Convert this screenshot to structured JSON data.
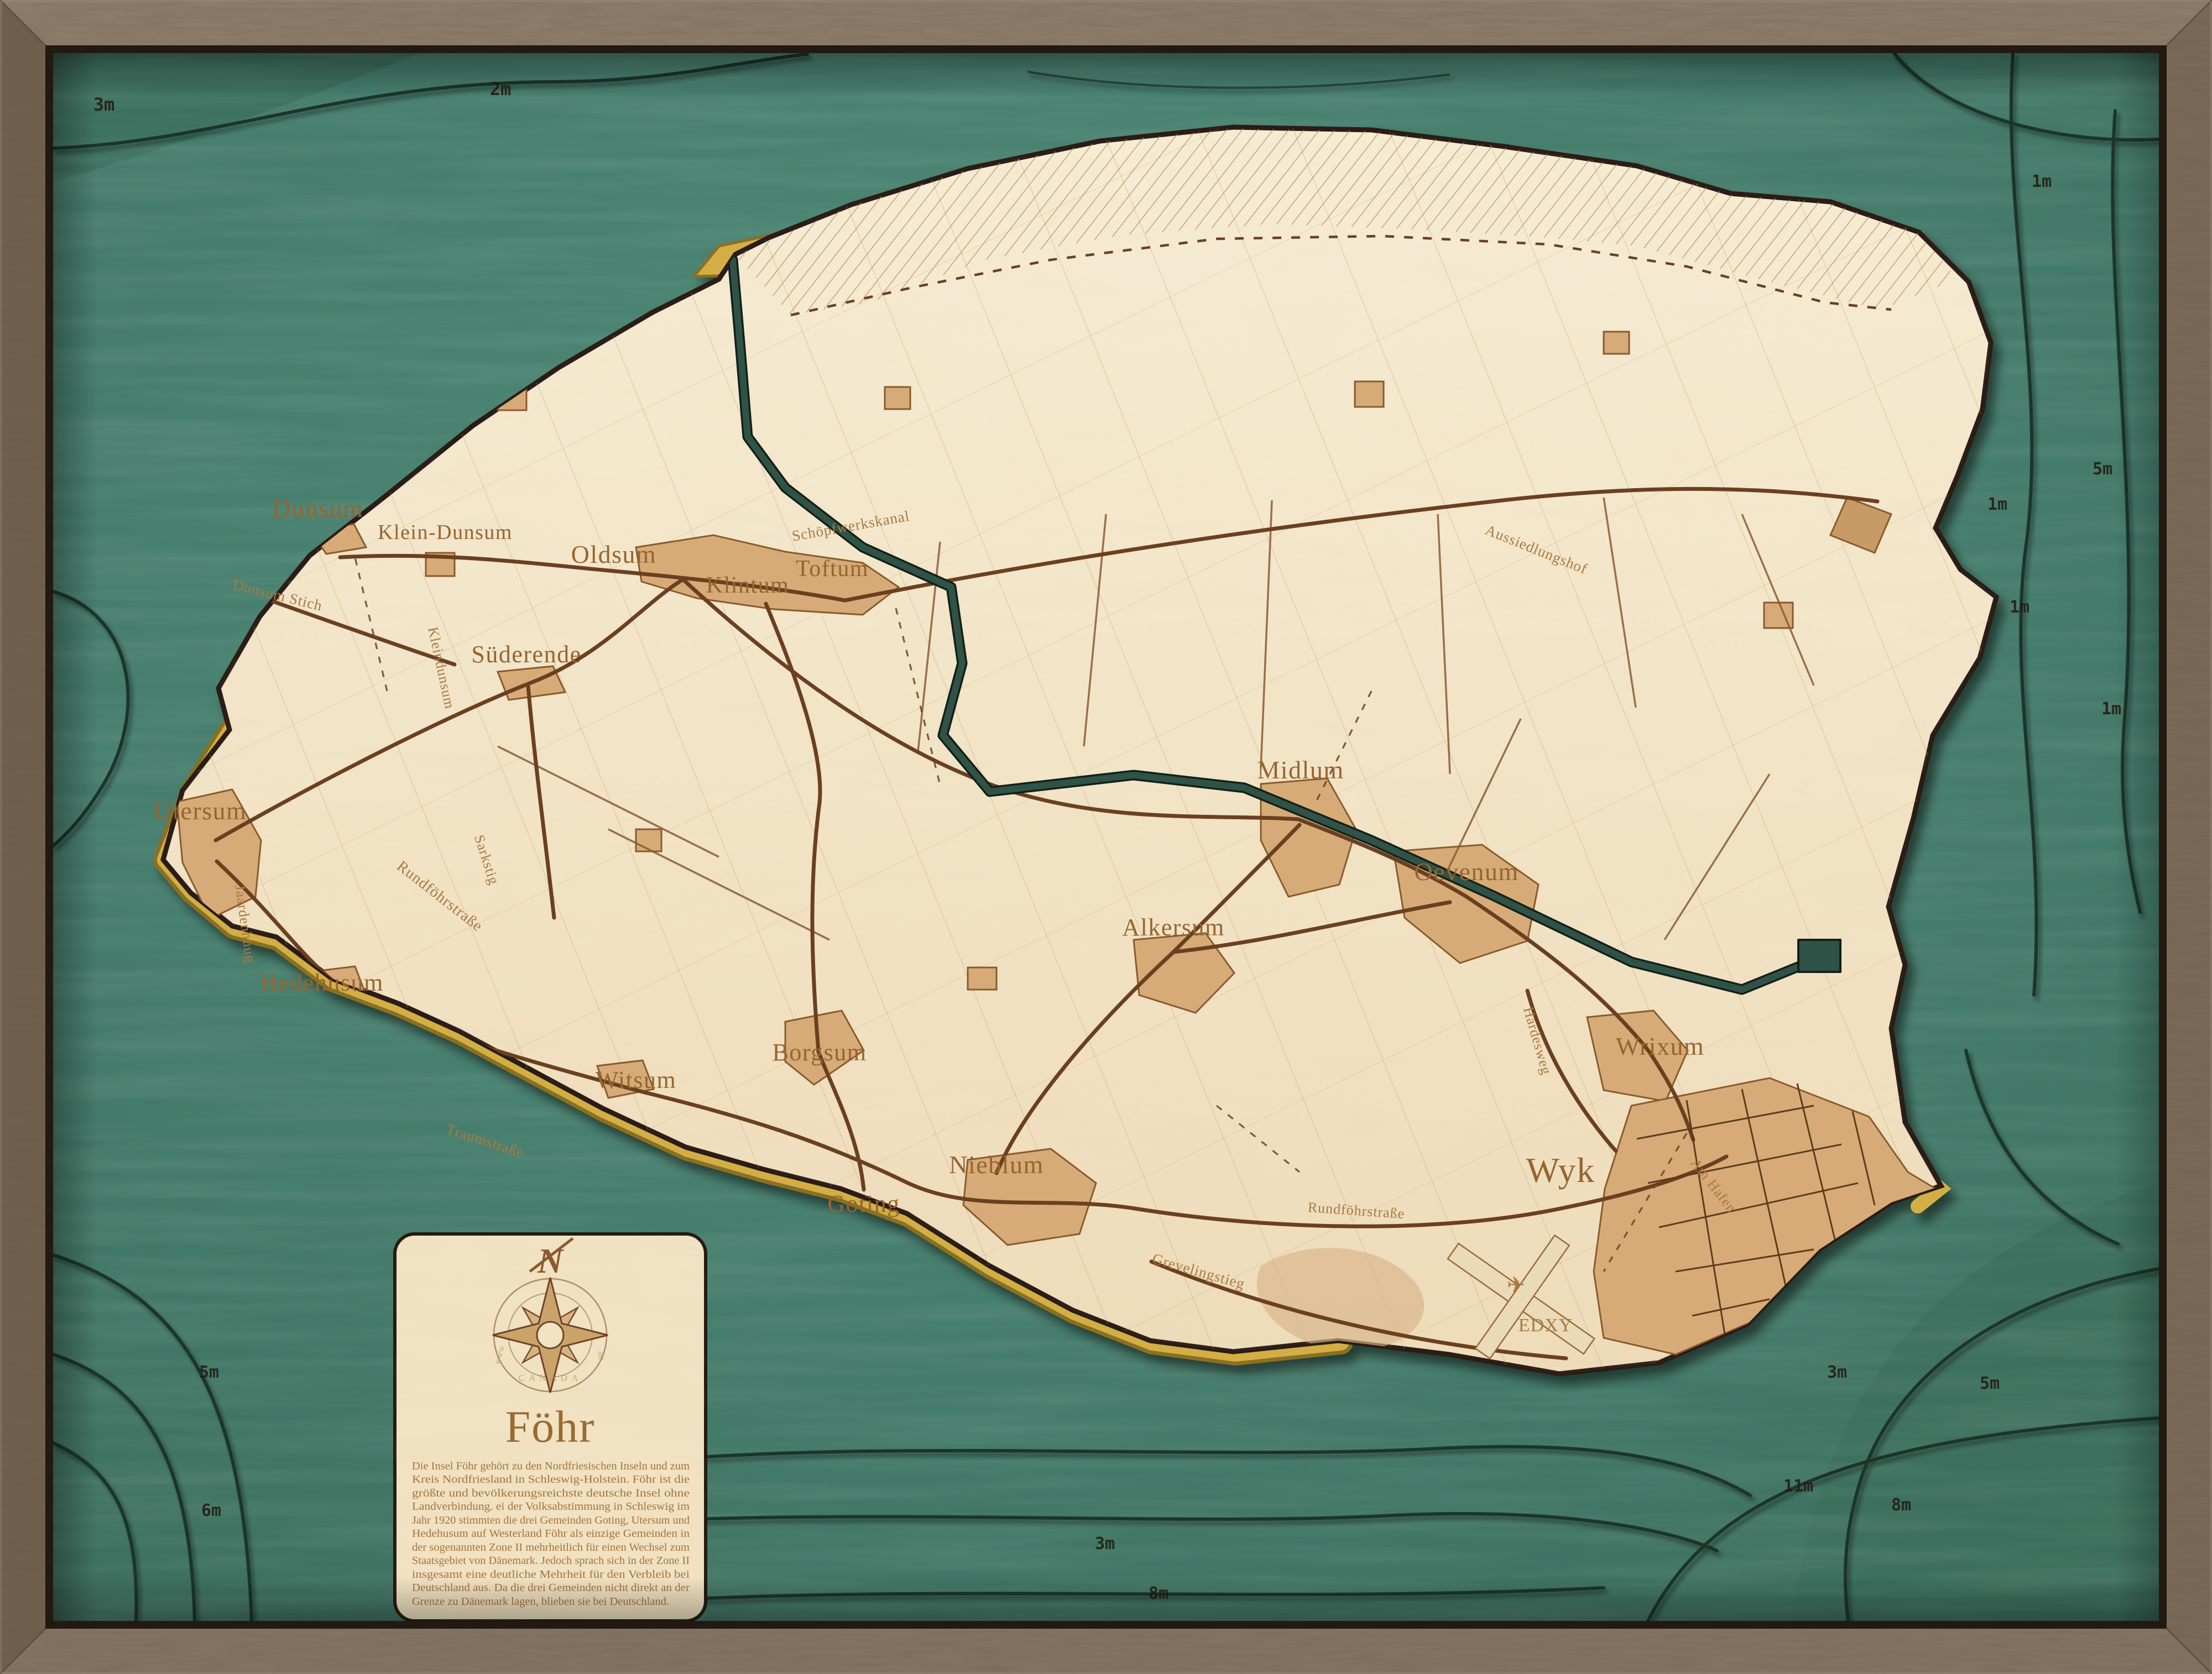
{
  "artwork": {
    "type": "3d-wood-bathymetric-chart",
    "island_name": "Föhr",
    "colors": {
      "frame_wood": "#84725f",
      "water_teal": "#457c6b",
      "water_deep": "#3a6a59",
      "island_cream": "#f2e4c4",
      "settlement_tan": "#d7ab77",
      "road_brown": "#6b4020",
      "sand_yellow": "#d2ae45",
      "canal_green": "#2f5346",
      "label_brown": "#96652f",
      "depth_ink": "#241c10"
    }
  },
  "map": {
    "towns": [
      {
        "name": "Dunsum"
      },
      {
        "name": "Klein-Dunsum"
      },
      {
        "name": "Oldsum"
      },
      {
        "name": "Klintum"
      },
      {
        "name": "Toftum"
      },
      {
        "name": "Süderende"
      },
      {
        "name": "Utersum"
      },
      {
        "name": "Hedehusum"
      },
      {
        "name": "Witsum"
      },
      {
        "name": "Borgsum"
      },
      {
        "name": "Goting"
      },
      {
        "name": "Nieblum"
      },
      {
        "name": "Midlum"
      },
      {
        "name": "Alkersum"
      },
      {
        "name": "Oevenum"
      },
      {
        "name": "Wrixum"
      },
      {
        "name": "Wyk"
      }
    ],
    "road_labels": [
      {
        "name": "Dunsum Stich"
      },
      {
        "name": "Kleindunsum"
      },
      {
        "name": "Schöpfwerkskanal"
      },
      {
        "name": "Rundföhrstraße"
      },
      {
        "name": "Jaardenhuug"
      },
      {
        "name": "Sarkstig"
      },
      {
        "name": "Traumstraße"
      },
      {
        "name": "Grevelingstieg"
      },
      {
        "name": "Hardesweg"
      },
      {
        "name": "Am Hafen"
      },
      {
        "name": "Aussiedlungshof"
      },
      {
        "name": "Rundföhrstraße"
      }
    ],
    "airport": {
      "code": "EDXY",
      "icon": "airplane-icon",
      "glyph": "✈"
    },
    "depths": [
      {
        "label": "3m"
      },
      {
        "label": "2m"
      },
      {
        "label": "1m"
      },
      {
        "label": "5m"
      },
      {
        "label": "1m"
      },
      {
        "label": "1m"
      },
      {
        "label": "1m"
      },
      {
        "label": "5m"
      },
      {
        "label": "6m"
      },
      {
        "label": "3m"
      },
      {
        "label": "5m"
      },
      {
        "label": "11m"
      },
      {
        "label": "8m"
      },
      {
        "label": "3m"
      },
      {
        "label": "8m"
      }
    ]
  },
  "legend": {
    "compass_letter": "N",
    "watermark_left": "www",
    "watermark_right": ".de",
    "watermark_bottom": "CANADA",
    "title": "Föhr",
    "lines": [
      "Die Insel Föhr gehört zu den Nordfriesischen Inseln und zum",
      "Kreis Nordfriesland in Schleswig-Holstein. Föhr ist die",
      "größte und bevölkerungsreichste deutsche Insel ohne",
      "Landverbindung. ei der Volksabstimmung in Schleswig im",
      "Jahr 1920 stimmten die drei Gemeinden Goting, Utersum und",
      "Hedehusum auf Westerland Föhr als einzige Gemeinden in",
      "der sogenannten Zone II mehrheitlich für einen Wechsel zum",
      "Staatsgebiet von Dänemark. Jedoch sprach sich in der Zone II",
      "insgesamt eine deutliche Mehrheit für den Verbleib bei",
      "Deutschland aus. Da die drei Gemeinden nicht direkt an der",
      "Grenze zu Dänemark lagen, blieben sie bei Deutschland."
    ]
  }
}
